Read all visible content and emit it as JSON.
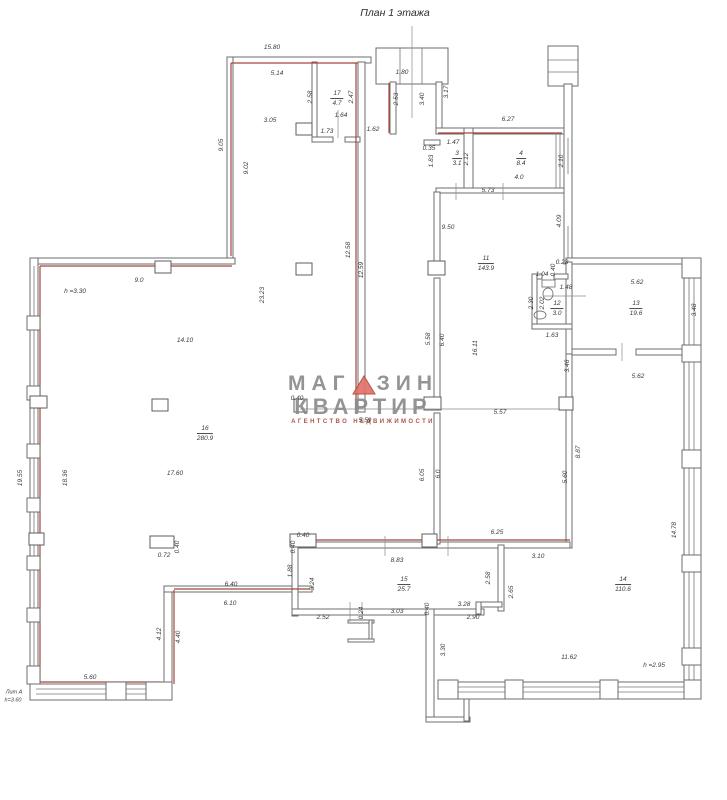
{
  "title": "План 1 этажа",
  "watermark": {
    "line1a": "МАГ",
    "line1b": "ЗИН",
    "line2": "КВАРТИР",
    "line3": "агентство недвижимости",
    "triangle_fill": "#e0736b",
    "triangle_stroke": "#b5443c"
  },
  "colors": {
    "wall_gray": "#6e6e6e",
    "accent_red": "#a8453a",
    "text": "#3a3a3a"
  },
  "rooms": [
    {
      "num": "17",
      "area": "4.7",
      "x": 337,
      "y": 99
    },
    {
      "num": "3",
      "area": "3.1",
      "x": 457,
      "y": 159
    },
    {
      "num": "4",
      "area": "8.4",
      "x": 521,
      "y": 159
    },
    {
      "num": "11",
      "area": "143.9",
      "x": 486,
      "y": 264
    },
    {
      "num": "12",
      "area": "3.0",
      "x": 557,
      "y": 309
    },
    {
      "num": "13",
      "area": "19.6",
      "x": 636,
      "y": 309
    },
    {
      "num": "16",
      "area": "280.9",
      "x": 205,
      "y": 434
    },
    {
      "num": "15",
      "area": "25.7",
      "x": 404,
      "y": 585
    },
    {
      "num": "14",
      "area": "110.6",
      "x": 623,
      "y": 585
    }
  ],
  "labels": [
    {
      "t": "15.80",
      "x": 272,
      "y": 48
    },
    {
      "t": "5.14",
      "x": 277,
      "y": 74
    },
    {
      "t": "3.05",
      "x": 270,
      "y": 121
    },
    {
      "t": "1.64",
      "x": 341,
      "y": 116
    },
    {
      "t": "1.73",
      "x": 327,
      "y": 132
    },
    {
      "t": "1.62",
      "x": 373,
      "y": 130
    },
    {
      "t": "1.80",
      "x": 402,
      "y": 73
    },
    {
      "t": "6.27",
      "x": 508,
      "y": 120
    },
    {
      "t": "1.47",
      "x": 453,
      "y": 143
    },
    {
      "t": "4.0",
      "x": 519,
      "y": 178
    },
    {
      "t": "5.73",
      "x": 488,
      "y": 191
    },
    {
      "t": "0.35",
      "x": 429,
      "y": 149
    },
    {
      "t": "9.50",
      "x": 448,
      "y": 228
    },
    {
      "t": "0.28",
      "x": 562,
      "y": 263
    },
    {
      "t": "1.04",
      "x": 542,
      "y": 275
    },
    {
      "t": "1.48",
      "x": 566,
      "y": 288
    },
    {
      "t": "1.63",
      "x": 552,
      "y": 336
    },
    {
      "t": "5.62",
      "x": 637,
      "y": 283
    },
    {
      "t": "5.62",
      "x": 638,
      "y": 377
    },
    {
      "t": "h =3.30",
      "x": 75,
      "y": 292
    },
    {
      "t": "9.0",
      "x": 139,
      "y": 281
    },
    {
      "t": "14.10",
      "x": 185,
      "y": 341
    },
    {
      "t": "17.60",
      "x": 175,
      "y": 474
    },
    {
      "t": "5.57",
      "x": 500,
      "y": 413
    },
    {
      "t": "5.59",
      "x": 365,
      "y": 421
    },
    {
      "t": "0.40",
      "x": 297,
      "y": 399
    },
    {
      "t": "0.72",
      "x": 164,
      "y": 556
    },
    {
      "t": "6.40",
      "x": 231,
      "y": 585
    },
    {
      "t": "6.10",
      "x": 230,
      "y": 604
    },
    {
      "t": "5.60",
      "x": 90,
      "y": 678
    },
    {
      "t": "0.40",
      "x": 303,
      "y": 536
    },
    {
      "t": "8.83",
      "x": 397,
      "y": 561
    },
    {
      "t": "2.52",
      "x": 323,
      "y": 618
    },
    {
      "t": "3.03",
      "x": 397,
      "y": 612
    },
    {
      "t": "3.28",
      "x": 464,
      "y": 605
    },
    {
      "t": "2.90",
      "x": 473,
      "y": 618
    },
    {
      "t": "6.25",
      "x": 497,
      "y": 533
    },
    {
      "t": "3.10",
      "x": 538,
      "y": 557
    },
    {
      "t": "11.62",
      "x": 569,
      "y": 658
    },
    {
      "t": "h =2.95",
      "x": 654,
      "y": 666
    },
    {
      "t": "Лит А",
      "x": 14,
      "y": 693,
      "s": 1
    },
    {
      "t": "h=3.60",
      "x": 13,
      "y": 701,
      "s": 1
    },
    {
      "t": "9.05",
      "x": 222,
      "y": 145,
      "r": 1
    },
    {
      "t": "9.02",
      "x": 247,
      "y": 168,
      "r": 1
    },
    {
      "t": "2.58",
      "x": 311,
      "y": 97,
      "r": 1
    },
    {
      "t": "2.47",
      "x": 352,
      "y": 97,
      "r": 1
    },
    {
      "t": "2.53",
      "x": 397,
      "y": 99,
      "r": 1
    },
    {
      "t": "3.40",
      "x": 423,
      "y": 99,
      "r": 1
    },
    {
      "t": "3.17",
      "x": 447,
      "y": 92,
      "r": 1
    },
    {
      "t": "12.58",
      "x": 349,
      "y": 250,
      "r": 1
    },
    {
      "t": "12.59",
      "x": 362,
      "y": 270,
      "r": 1
    },
    {
      "t": "23.23",
      "x": 263,
      "y": 295,
      "r": 1
    },
    {
      "t": "1.83",
      "x": 432,
      "y": 161,
      "r": 1
    },
    {
      "t": "2.12",
      "x": 467,
      "y": 159,
      "r": 1
    },
    {
      "t": "2.10",
      "x": 562,
      "y": 161,
      "r": 1
    },
    {
      "t": "4.09",
      "x": 560,
      "y": 221,
      "r": 1
    },
    {
      "t": "0.40",
      "x": 554,
      "y": 270,
      "r": 1
    },
    {
      "t": "2.30",
      "x": 532,
      "y": 303,
      "r": 1
    },
    {
      "t": "2.02",
      "x": 543,
      "y": 303,
      "r": 1
    },
    {
      "t": "3.48",
      "x": 695,
      "y": 310,
      "r": 1
    },
    {
      "t": "3.46",
      "x": 568,
      "y": 366,
      "r": 1
    },
    {
      "t": "5.58",
      "x": 429,
      "y": 339,
      "r": 1
    },
    {
      "t": "6.40",
      "x": 443,
      "y": 340,
      "r": 1
    },
    {
      "t": "16.11",
      "x": 476,
      "y": 348,
      "r": 1
    },
    {
      "t": "8.87",
      "x": 579,
      "y": 452,
      "r": 1
    },
    {
      "t": "5.60",
      "x": 566,
      "y": 477,
      "r": 1
    },
    {
      "t": "6.05",
      "x": 423,
      "y": 475,
      "r": 1
    },
    {
      "t": "6.0",
      "x": 439,
      "y": 474,
      "r": 1
    },
    {
      "t": "19.55",
      "x": 21,
      "y": 478,
      "r": 1
    },
    {
      "t": "18.36",
      "x": 66,
      "y": 478,
      "r": 1
    },
    {
      "t": "0.40",
      "x": 178,
      "y": 547,
      "r": 1
    },
    {
      "t": "0.40",
      "x": 294,
      "y": 547,
      "r": 1
    },
    {
      "t": "1.88",
      "x": 291,
      "y": 571,
      "r": 1
    },
    {
      "t": "3.24",
      "x": 313,
      "y": 584,
      "r": 1
    },
    {
      "t": "2.58",
      "x": 489,
      "y": 578,
      "r": 1
    },
    {
      "t": "2.65",
      "x": 512,
      "y": 592,
      "r": 1
    },
    {
      "t": "0.24",
      "x": 362,
      "y": 613,
      "r": 1
    },
    {
      "t": "0.40",
      "x": 428,
      "y": 609,
      "r": 1
    },
    {
      "t": "3.30",
      "x": 444,
      "y": 650,
      "r": 1
    },
    {
      "t": "4.12",
      "x": 160,
      "y": 634,
      "r": 1
    },
    {
      "t": "4.40",
      "x": 179,
      "y": 637,
      "r": 1
    },
    {
      "t": "14.78",
      "x": 675,
      "y": 530,
      "r": 1
    }
  ]
}
